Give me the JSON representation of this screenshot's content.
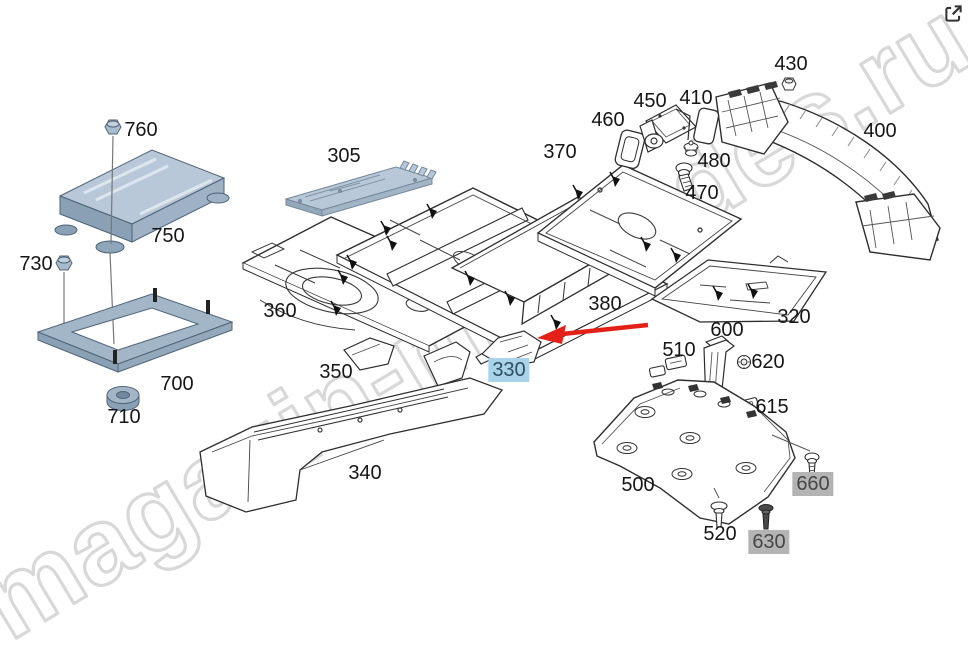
{
  "watermark": {
    "text": "magazin-mercedes.ru",
    "color": "#d8d8d8"
  },
  "header": {
    "external_link_icon": "open-external-icon"
  },
  "annotation": {
    "type": "arrow",
    "points_to": "330",
    "arrow_color": "#e32119"
  },
  "colors": {
    "highlight_blue_bg": "#a8d3e8",
    "highlight_blue_text": "#2e4e63",
    "highlight_gray_bg": "#b4b4b4",
    "highlight_gray_text": "#474747",
    "part_blue_fill": "#b9c8d8",
    "line_art": "#2e2e2e",
    "arrow_red": "#e32119"
  },
  "labels": [
    {
      "text": "760",
      "x": 141,
      "y": 130,
      "style": "plain"
    },
    {
      "text": "750",
      "x": 168,
      "y": 236,
      "style": "plain"
    },
    {
      "text": "730",
      "x": 36,
      "y": 264,
      "style": "plain"
    },
    {
      "text": "700",
      "x": 177,
      "y": 384,
      "style": "plain"
    },
    {
      "text": "710",
      "x": 124,
      "y": 417,
      "style": "plain"
    },
    {
      "text": "305",
      "x": 344,
      "y": 156,
      "style": "plain"
    },
    {
      "text": "360",
      "x": 280,
      "y": 311,
      "style": "plain"
    },
    {
      "text": "350",
      "x": 336,
      "y": 372,
      "style": "plain"
    },
    {
      "text": "340",
      "x": 365,
      "y": 473,
      "style": "plain"
    },
    {
      "text": "330",
      "x": 509,
      "y": 370,
      "style": "highlight-blue"
    },
    {
      "text": "370",
      "x": 560,
      "y": 152,
      "style": "plain"
    },
    {
      "text": "380",
      "x": 605,
      "y": 304,
      "style": "plain"
    },
    {
      "text": "320",
      "x": 794,
      "y": 317,
      "style": "plain"
    },
    {
      "text": "400",
      "x": 880,
      "y": 131,
      "style": "plain"
    },
    {
      "text": "430",
      "x": 791,
      "y": 64,
      "style": "plain"
    },
    {
      "text": "450",
      "x": 650,
      "y": 101,
      "style": "plain"
    },
    {
      "text": "410",
      "x": 696,
      "y": 98,
      "style": "plain"
    },
    {
      "text": "460",
      "x": 608,
      "y": 120,
      "style": "plain"
    },
    {
      "text": "480",
      "x": 714,
      "y": 161,
      "style": "plain"
    },
    {
      "text": "470",
      "x": 702,
      "y": 193,
      "style": "plain"
    },
    {
      "text": "600",
      "x": 727,
      "y": 330,
      "style": "plain"
    },
    {
      "text": "510",
      "x": 679,
      "y": 350,
      "style": "plain"
    },
    {
      "text": "620",
      "x": 768,
      "y": 362,
      "style": "plain"
    },
    {
      "text": "615",
      "x": 772,
      "y": 407,
      "style": "plain"
    },
    {
      "text": "500",
      "x": 638,
      "y": 485,
      "style": "plain"
    },
    {
      "text": "660",
      "x": 813,
      "y": 484,
      "style": "highlight-gray"
    },
    {
      "text": "520",
      "x": 720,
      "y": 534,
      "style": "plain"
    },
    {
      "text": "630",
      "x": 769,
      "y": 542,
      "style": "highlight-gray"
    }
  ]
}
